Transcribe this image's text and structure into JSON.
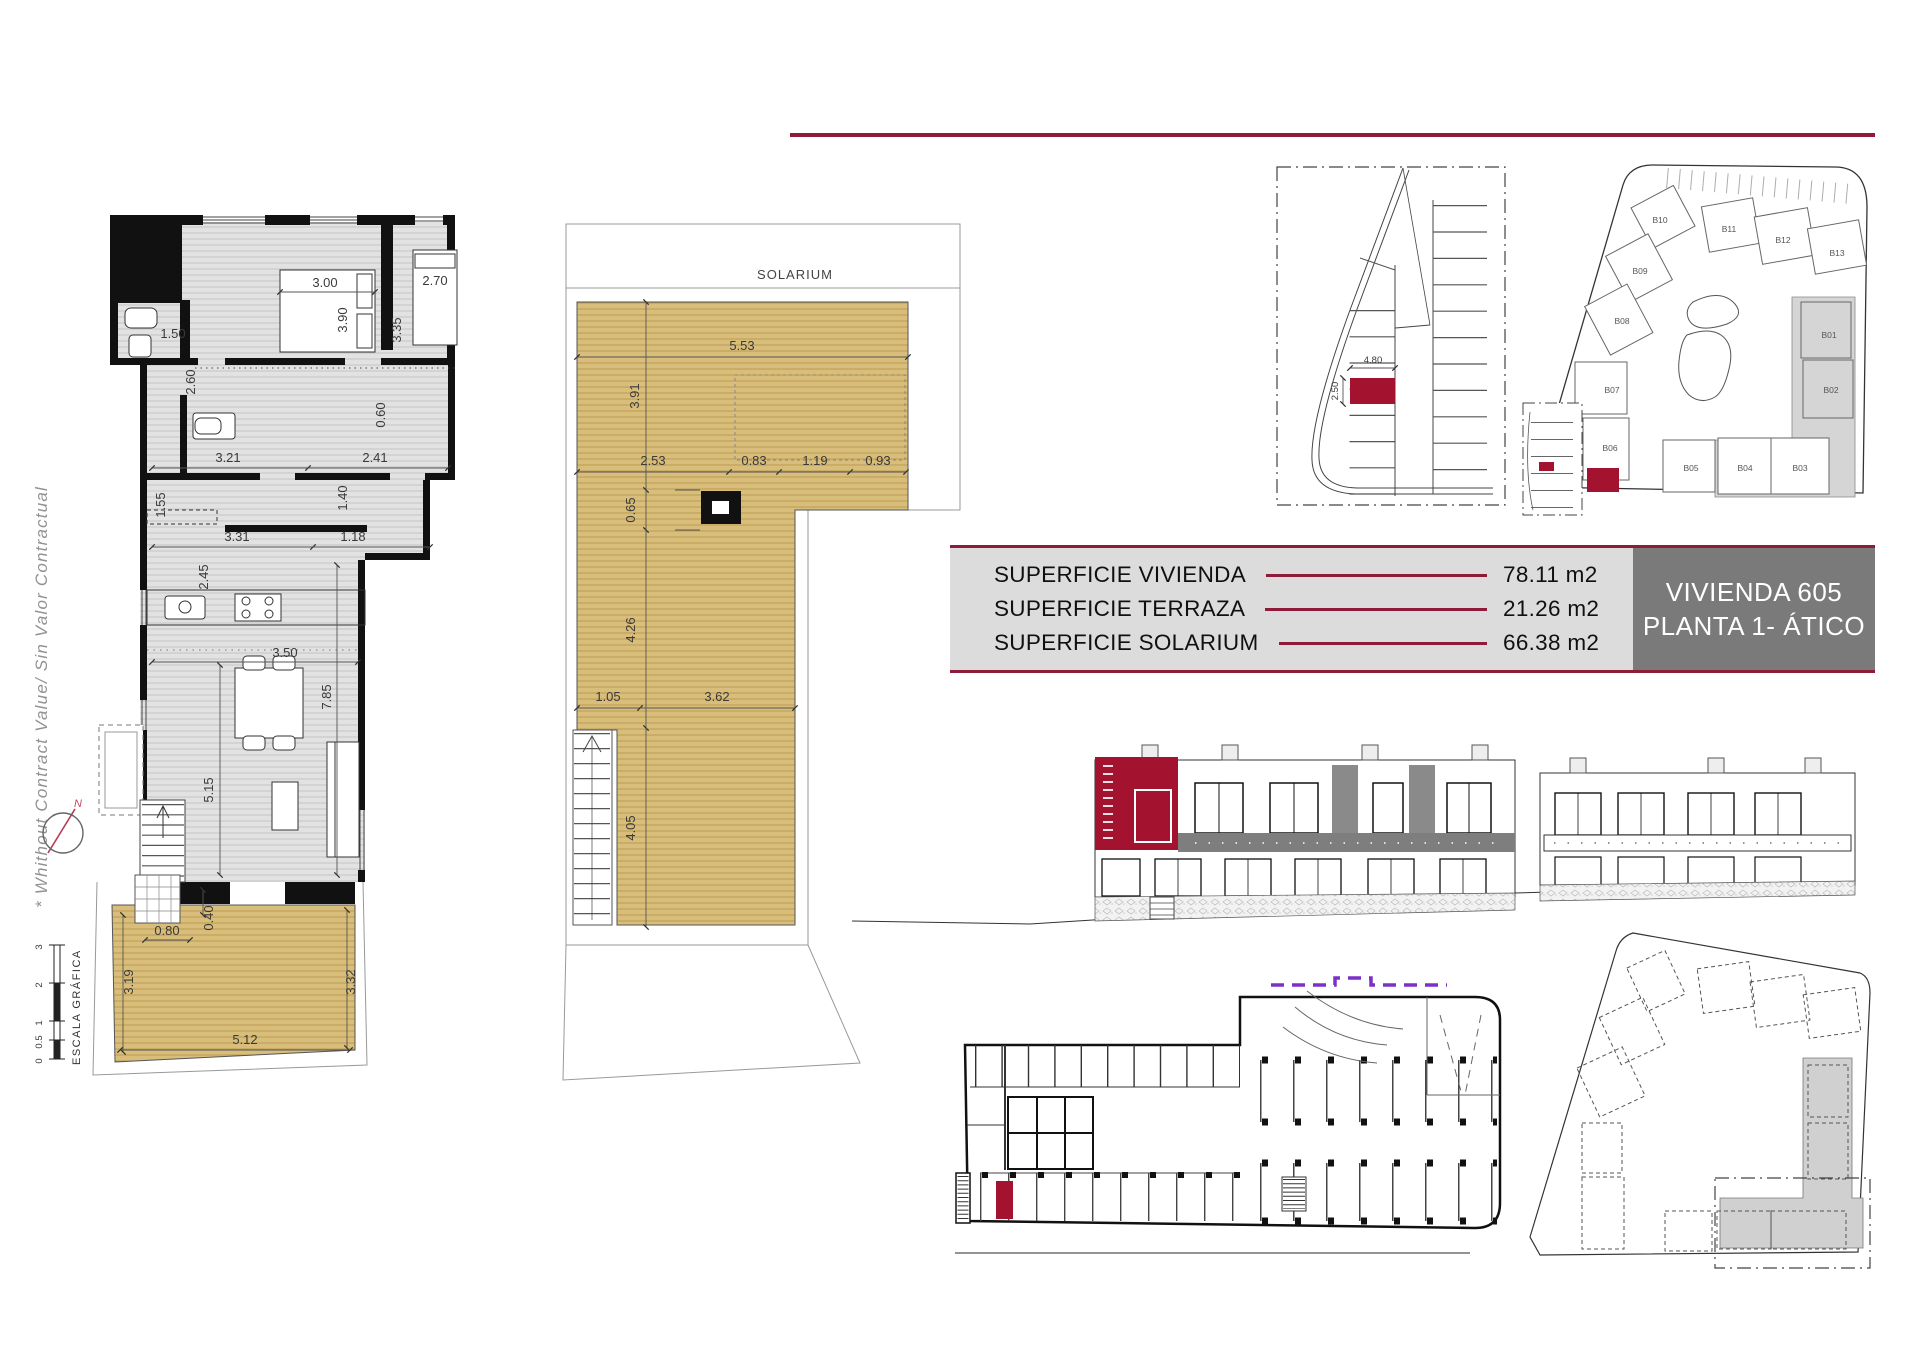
{
  "sheet": {
    "side_note": "* Whithout Contract Value/ Sin Valor Contractual",
    "scale_label": "ESCALA GRÁFICA",
    "scale_ticks": [
      "3",
      "2",
      "1",
      "0.5",
      "0"
    ],
    "north_label": "N"
  },
  "title_block": {
    "rows": [
      {
        "label": "SUPERFICIE VIVIENDA",
        "value": "78.11 m2"
      },
      {
        "label": "SUPERFICIE TERRAZA",
        "value": "21.26 m2"
      },
      {
        "label": "SUPERFICIE SOLARIUM",
        "value": "66.38 m2"
      }
    ],
    "unit_line1": "VIVIENDA 605",
    "unit_line2": "PLANTA 1- ÁTICO"
  },
  "apartment_plan": {
    "dims": {
      "bed1_w": "3.00",
      "bed1_h": "3.90",
      "bed2_w": "2.70",
      "bed2_h": "3.35",
      "bath_w": "1.50",
      "bath_h": "2.60",
      "closet": "0.60",
      "hall_left": "3.21",
      "hall_right": "2.41",
      "store_h": "1.55",
      "hall_h": "1.40",
      "kitchen_w": "3.31",
      "pass_w": "1.18",
      "kitchen_h": "2.45",
      "living_w": "3.50",
      "living_h": "7.85",
      "stair_h": "5.15",
      "terrace_in": "0.80",
      "terrace_step": "0.40",
      "terrace_left": "3.19",
      "terrace_right": "3.32",
      "terrace_w": "5.12"
    }
  },
  "solarium_plan": {
    "label": "SOLARIUM",
    "dims": {
      "top_w": "5.53",
      "top_h": "3.91",
      "seg1": "2.53",
      "seg2": "0.83",
      "seg3": "1.19",
      "seg4": "0.93",
      "chimney": "0.65",
      "mid_h": "4.26",
      "low_left": "1.05",
      "low_w": "3.62",
      "low_h": "4.05"
    }
  },
  "parking_plan": {
    "stall_w": "4.80",
    "stall_h": "2.50"
  },
  "site_plan": {
    "blocks": [
      "B01",
      "B02",
      "B03",
      "B04",
      "B05",
      "B06",
      "B07",
      "B08",
      "B09",
      "B10",
      "B11",
      "B12",
      "B13"
    ]
  },
  "colors": {
    "accent": "#8E1B3A",
    "highlight": "#A3132F",
    "tan": "#D9BD7B",
    "floor_gray": "#E2E2E2",
    "panel_gray": "#7A7A7A",
    "table_gray": "#DCDCDC",
    "purple": "#7D30C9"
  }
}
